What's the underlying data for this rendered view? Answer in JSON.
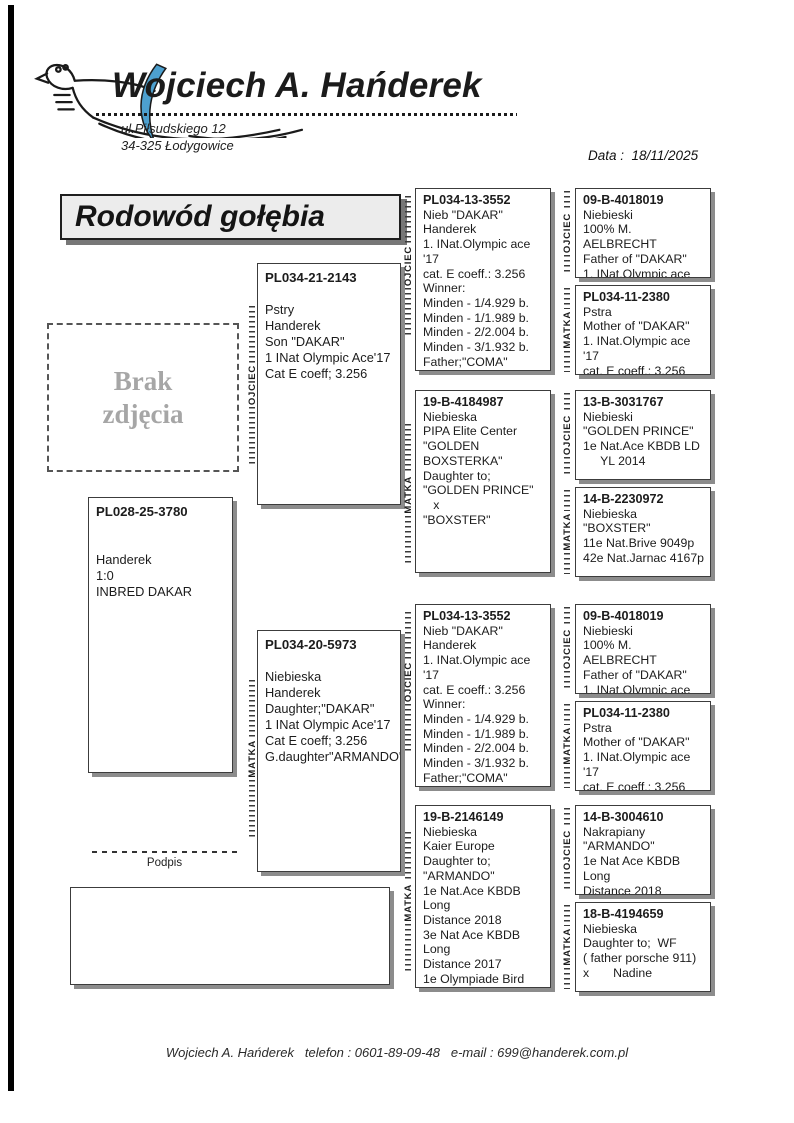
{
  "header": {
    "name": "Wojciech A. Hańderek",
    "address1": "ul.Piłsudskiego 12",
    "address2": "34-325 Łodygowice",
    "date_text": "Data :  18/11/2025"
  },
  "title": "Rodowód gołębia",
  "photo": {
    "placeholder": "Brak zdjęcia"
  },
  "labels": {
    "father": "OJCIEC",
    "mother": "MATKA",
    "signature": "Podpis"
  },
  "pedigree": {
    "subject": {
      "id": "PL028-25-3780",
      "lines": [
        "",
        "",
        "Handerek",
        "1:0",
        "INBRED DAKAR"
      ]
    },
    "father": {
      "id": "PL034-21-2143",
      "lines": [
        "",
        "Pstry",
        "Handerek",
        "Son \"DAKAR\"",
        "1 INat Olympic Ace'17",
        "Cat E coeff; 3.256"
      ]
    },
    "mother": {
      "id": "PL034-20-5973",
      "lines": [
        "",
        "Niebieska",
        "Handerek",
        "Daughter;\"DAKAR\"",
        "1 INat Olympic Ace'17",
        "Cat E coeff; 3.256",
        "G.daughter\"ARMANDO\""
      ]
    },
    "grandparents": [
      {
        "id": "PL034-13-3552",
        "lines": [
          "Nieb \"DAKAR\"",
          "Handerek",
          "1. INat.Olympic ace '17",
          "cat. E coeff.: 3.256",
          "Winner:",
          "Minden - 1/4.929 b.",
          "Minden - 1/1.989 b.",
          "Minden - 2/2.004 b.",
          "Minden - 3/1.932 b.",
          "Father;\"COMA\"",
          "2 INat Olympic Ace'22"
        ]
      },
      {
        "id": "19-B-4184987",
        "lines": [
          "Niebieska",
          "PIPA Elite Center",
          "\"GOLDEN",
          "BOXSTERKA\"",
          "Daughter to;",
          "\"GOLDEN PRINCE\"",
          "   x",
          "\"BOXSTER\""
        ]
      },
      {
        "id": "PL034-13-3552",
        "lines": [
          "Nieb \"DAKAR\"",
          "Handerek",
          "1. INat.Olympic ace '17",
          "cat. E coeff.: 3.256",
          "Winner:",
          "Minden - 1/4.929 b.",
          "Minden - 1/1.989 b.",
          "Minden - 2/2.004 b.",
          "Minden - 3/1.932 b.",
          "Father;\"COMA\"",
          "2 INat Olympic Ace'22"
        ]
      },
      {
        "id": "19-B-2146149",
        "lines": [
          "Niebieska",
          "Kaier Europe",
          "Daughter to;",
          "\"ARMANDO\"",
          "1e Nat.Ace KBDB Long",
          "Distance 2018",
          "3e Nat Ace KBDB Long",
          "Distance 2017",
          "1e Olympiade Bird",
          "Cat C Poland 2019",
          "1e Nat Angouleme\"18"
        ]
      }
    ],
    "great_grandparents": [
      {
        "id": "09-B-4018019",
        "lines": [
          "Niebieski",
          "100% M. AELBRECHT",
          "Father of \"DAKAR\"",
          "1. INat.Olympic ace '17"
        ]
      },
      {
        "id": "PL034-11-2380",
        "lines": [
          "Pstra",
          "Mother of \"DAKAR\"",
          "1. INat.Olympic ace '17",
          "cat. E coeff.: 3.256"
        ]
      },
      {
        "id": "13-B-3031767",
        "lines": [
          "Niebieski",
          "\"GOLDEN PRINCE\"",
          "1e Nat.Ace KBDB LD",
          "     YL 2014"
        ]
      },
      {
        "id": "14-B-2230972",
        "lines": [
          "Niebieska",
          "\"BOXSTER\"",
          "11e Nat.Brive 9049p",
          "42e Nat.Jarnac 4167p"
        ]
      },
      {
        "id": "09-B-4018019",
        "lines": [
          "Niebieski",
          "100% M. AELBRECHT",
          "Father of \"DAKAR\"",
          "1. INat.Olympic ace '17"
        ]
      },
      {
        "id": "PL034-11-2380",
        "lines": [
          "Pstra",
          "Mother of \"DAKAR\"",
          "1. INat.Olympic ace '17",
          "cat. E coeff.: 3.256"
        ]
      },
      {
        "id": "14-B-3004610",
        "lines": [
          "Nakrapiany",
          "\"ARMANDO\"",
          "1e Nat Ace KBDB Long",
          "Distance 2018"
        ]
      },
      {
        "id": "18-B-4194659",
        "lines": [
          "Niebieska",
          "Daughter to;  WF",
          "( father porsche 911)",
          "x       Nadine"
        ]
      }
    ]
  },
  "footer": {
    "text": "Wojciech A. Hańderek   telefon : 0601-89-09-48   e-mail : 699@handerek.com.pl"
  },
  "colors": {
    "wing_blue": "#4DA0CF",
    "shadow_gray": "#8c8c8c",
    "title_bg": "#ececec",
    "photo_text_gray": "#a6a6a6"
  }
}
